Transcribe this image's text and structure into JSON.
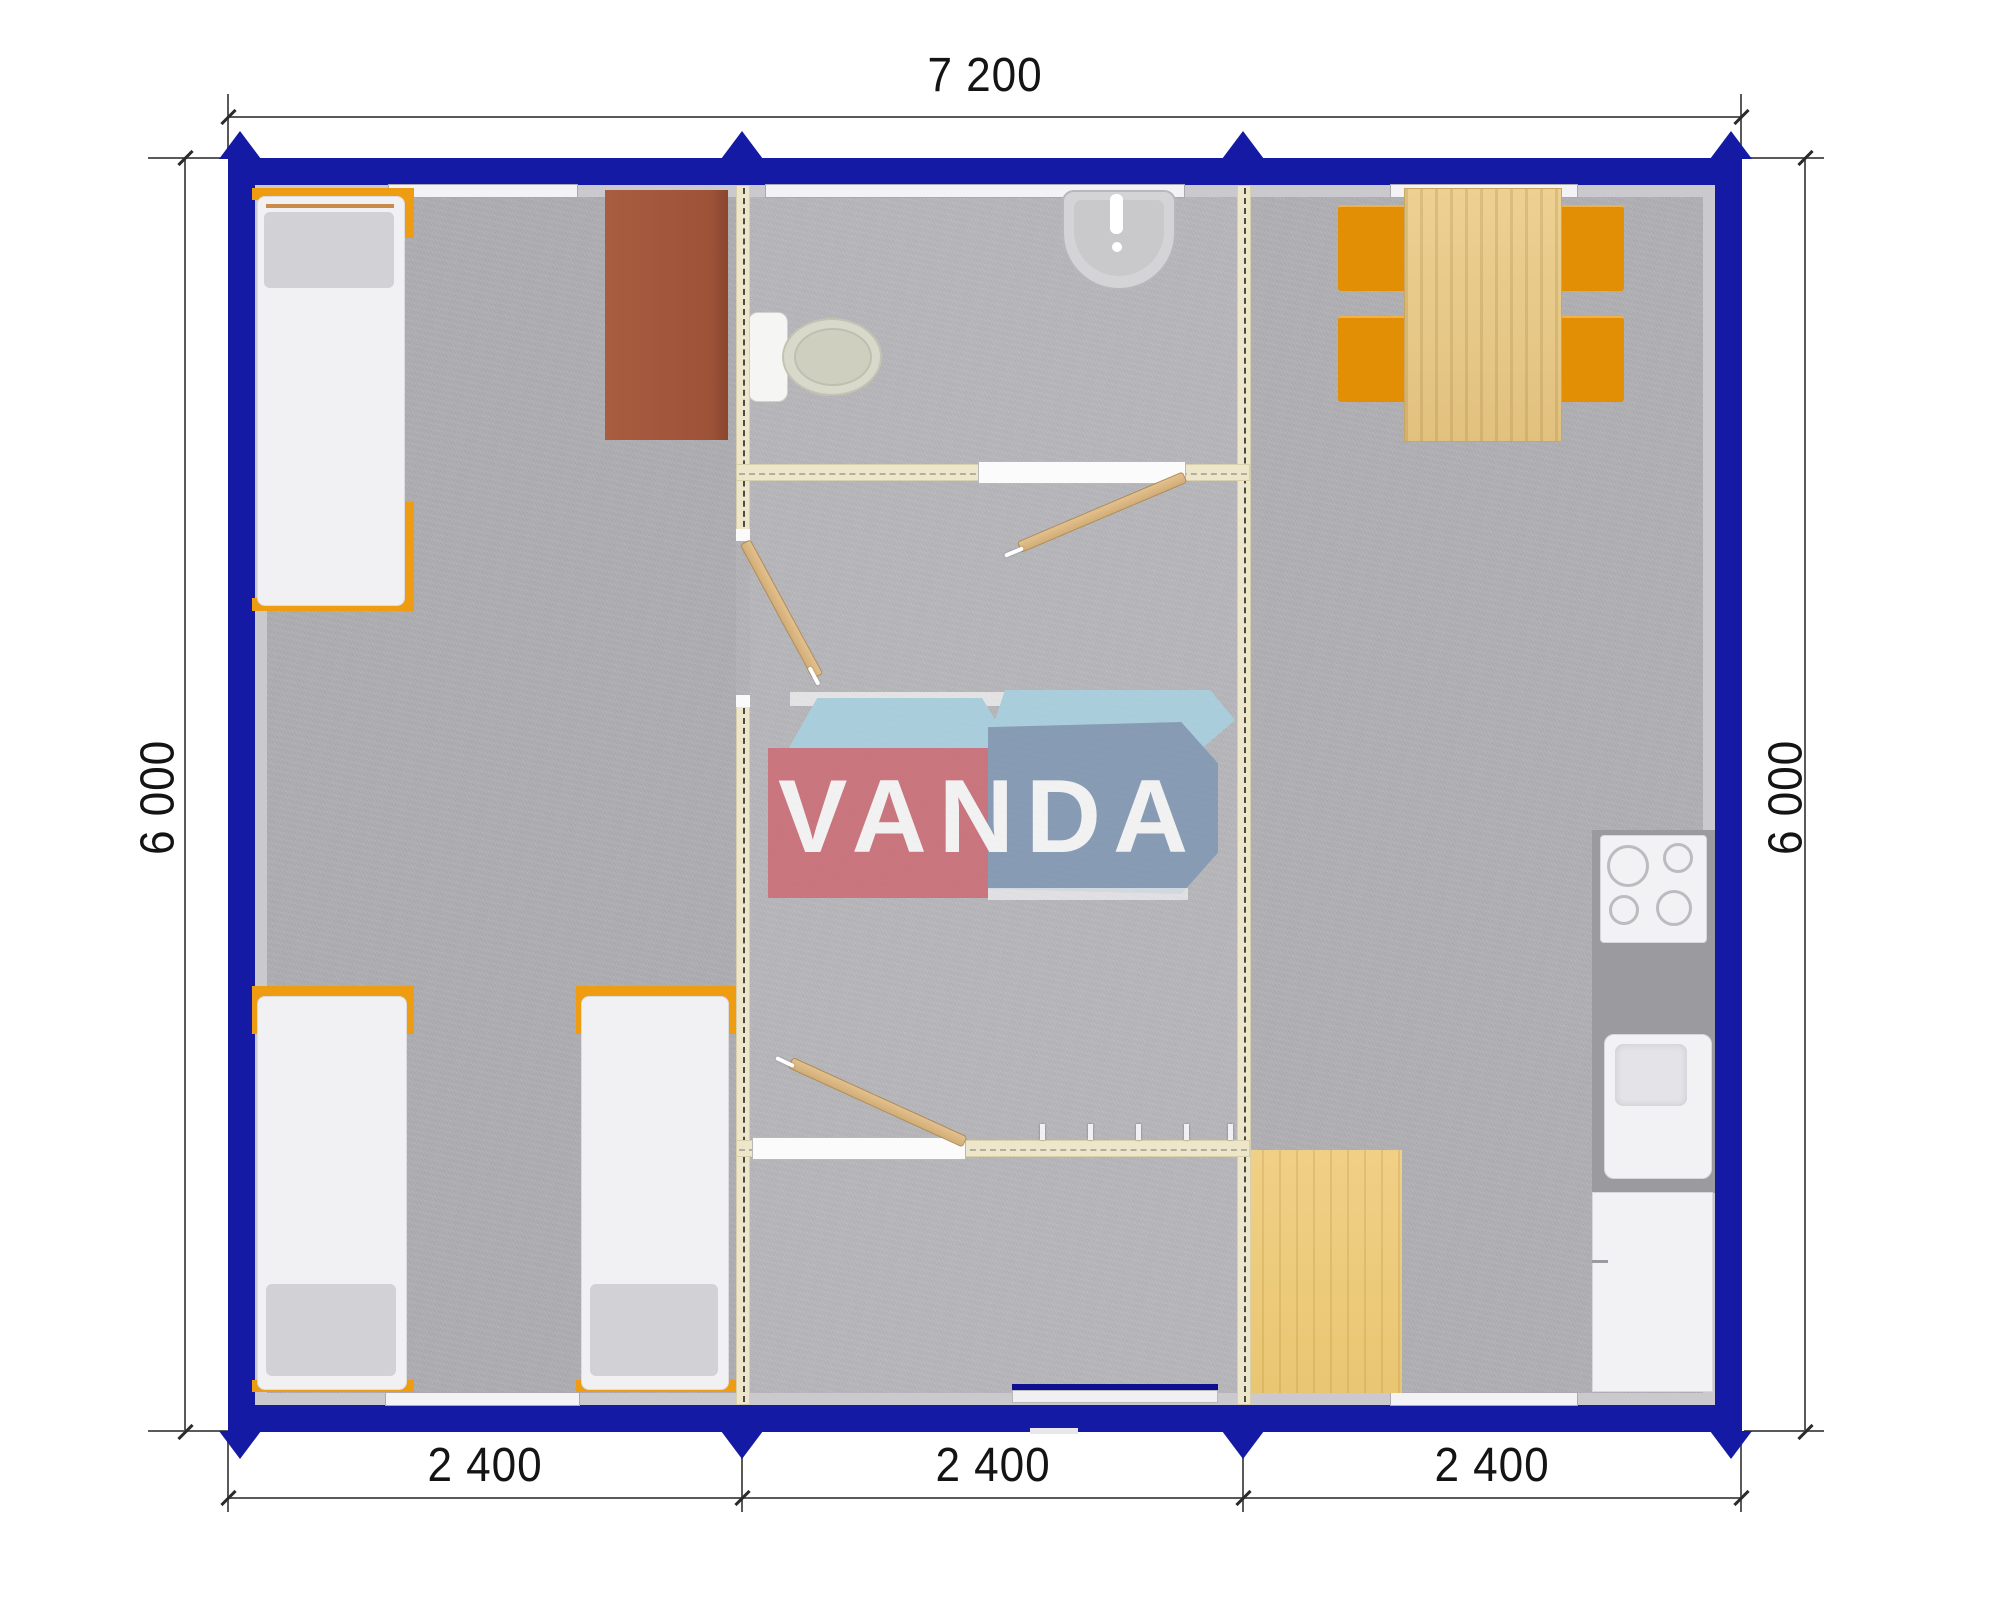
{
  "dimensions": {
    "top": "7 200",
    "left": "6 000",
    "right": "6 000",
    "bottom": [
      "2 400",
      "2 400",
      "2 400"
    ]
  },
  "watermark": {
    "text": "VANDA"
  },
  "colors": {
    "wall_blue": "#151aa5",
    "partition_cream": "#ede6ca",
    "furniture_orange": "#ee9c12",
    "table_wood": "#e8cc8e",
    "door_wood": "#d9b583",
    "desk_brown": "#a2573b",
    "floor_gray": "#b3b3b7",
    "logo_red": "#ce6872",
    "logo_blue": "#7e96b3",
    "logo_lightblue": "#a7d3e3"
  }
}
